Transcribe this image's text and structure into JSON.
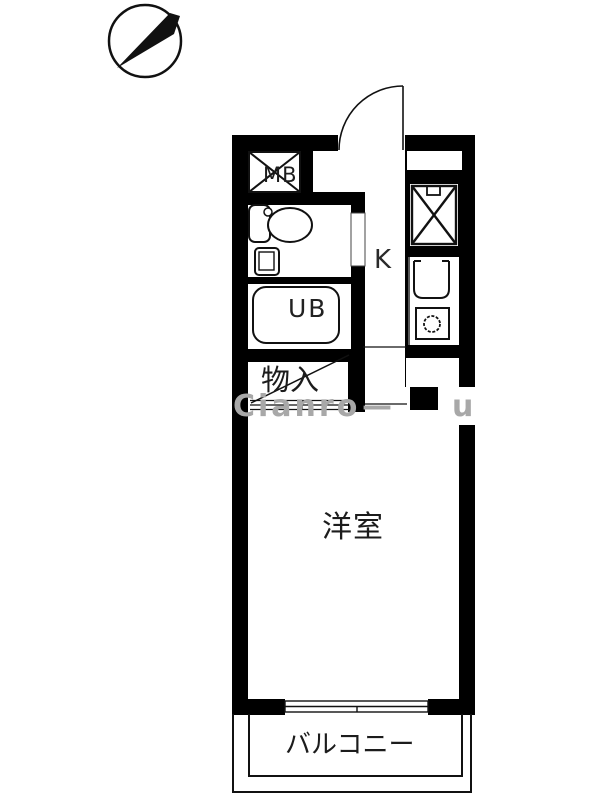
{
  "colors": {
    "wall": "#000000",
    "line": "#111111",
    "text": "#1c1c1c",
    "watermark": "#a8a8a8",
    "background": "#ffffff"
  },
  "compass": {
    "icon": "north-arrow-icon",
    "direction": "upper-right"
  },
  "rooms": {
    "meter_box": {
      "label": "MB"
    },
    "kitchen": {
      "label": "K"
    },
    "unit_bath": {
      "label": "UB"
    },
    "closet": {
      "label": "物入"
    },
    "western_room": {
      "label": "洋室"
    },
    "balcony": {
      "label": "バルコニー"
    }
  },
  "fixtures": {
    "meter_box": "x-box-icon",
    "washer_space": "x-box-faucet-icon",
    "toilet": "toilet-icon",
    "hand_sink": "small-sink-icon",
    "bathtub": "bathtub-icon",
    "kitchen_sink": "sink-icon",
    "stove": "burner-icon",
    "entrance_door": "door-swing-icon",
    "closet_door": "sliding-door-lines-icon",
    "window": "sliding-window-icon"
  },
  "watermark": {
    "parts": [
      "Cianro",
      "—",
      "u"
    ]
  }
}
